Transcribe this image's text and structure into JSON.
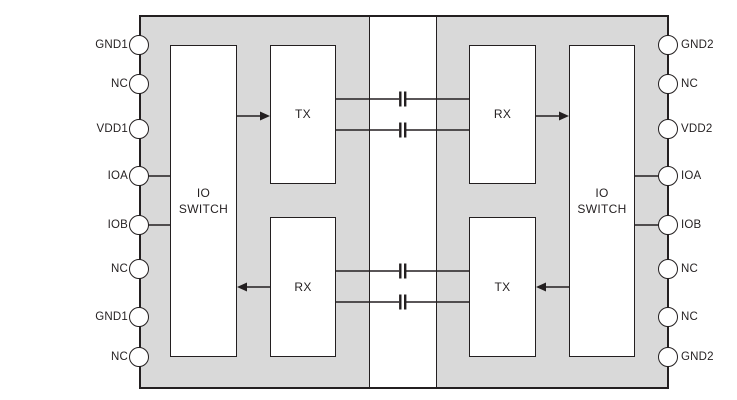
{
  "diagram": {
    "type": "functional-block-diagram",
    "colors": {
      "chip_fill": "#d9d9d9",
      "block_fill": "#ffffff",
      "line": "#231f20",
      "text": "#231f20",
      "page_background": "#ffffff"
    },
    "left_side": {
      "pins": [
        "GND1",
        "NC",
        "VDD1",
        "IOA",
        "IOB",
        "NC",
        "GND1",
        "NC"
      ],
      "blocks": {
        "io_switch": "IO\nSWITCH",
        "tx": "TX",
        "rx": "RX"
      }
    },
    "right_side": {
      "pins": [
        "GND2",
        "NC",
        "VDD2",
        "IOA",
        "IOB",
        "NC",
        "NC",
        "GND2"
      ],
      "blocks": {
        "rx": "RX",
        "tx": "TX",
        "io_switch": "IO\nSWITCH"
      }
    },
    "isolation_barrier": {
      "capacitor_count": 4
    }
  }
}
